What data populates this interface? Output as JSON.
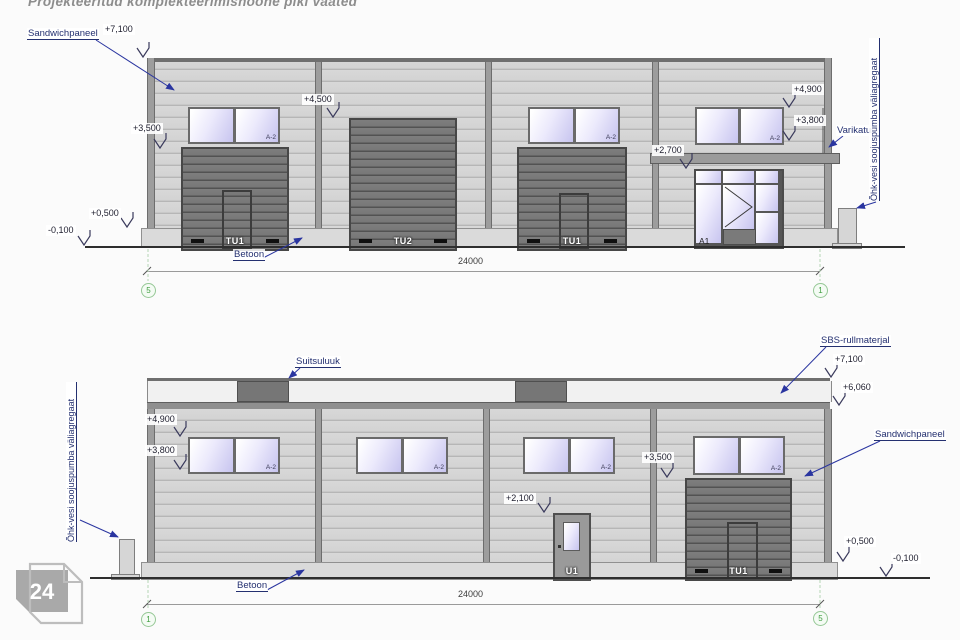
{
  "title": "Projekteeritud komplekteerimishoone piki vaated",
  "logo": {
    "number": "24"
  },
  "colors": {
    "wall_gray": "#d4d4d4",
    "door_gray": "#6e6e6e",
    "window_glass": "#d6d3f4",
    "annotation_navy": "#243070",
    "grid_green": "#3f9e3f",
    "logo_gray": "#a9a9a9"
  },
  "top": {
    "labels": {
      "sandwichpaneel": "Sandwichpaneel",
      "varikatus": "Varikatus",
      "heatpump": "Õhk-vesi soojuspumba väliagregaat",
      "betoon": "Betoon"
    },
    "levels": {
      "l7100": "+7,100",
      "l3500": "+3,500",
      "l4500": "+4,500",
      "l4900": "+4,900",
      "l3800": "+3,800",
      "l2700": "+2,700",
      "l0500": "+0,500",
      "lm0100": "-0,100"
    },
    "doors": {
      "tu1": "TU1",
      "tu2": "TU2",
      "a1": "A1"
    },
    "window_tag": "A-2",
    "dimension": "24000",
    "grid_left": "5",
    "grid_right": "1"
  },
  "bottom": {
    "labels": {
      "suitsuluuk": "Suitsuluuk",
      "sbs": "SBS-rullmaterjal",
      "sandwichpaneel": "Sandwichpaneel",
      "heatpump": "Õhk-vesi soojuspumba väliagregaat",
      "betoon": "Betoon"
    },
    "levels": {
      "l7100": "+7,100",
      "l6060": "+6,060",
      "l4900": "+4,900",
      "l3800": "+3,800",
      "l3500": "+3,500",
      "l2100": "+2,100",
      "l0500": "+0,500",
      "lm0100": "-0,100"
    },
    "doors": {
      "tu1": "TU1",
      "u1": "U1"
    },
    "window_tag": "A-2",
    "dimension": "24000",
    "grid_left": "1",
    "grid_right": "5"
  }
}
